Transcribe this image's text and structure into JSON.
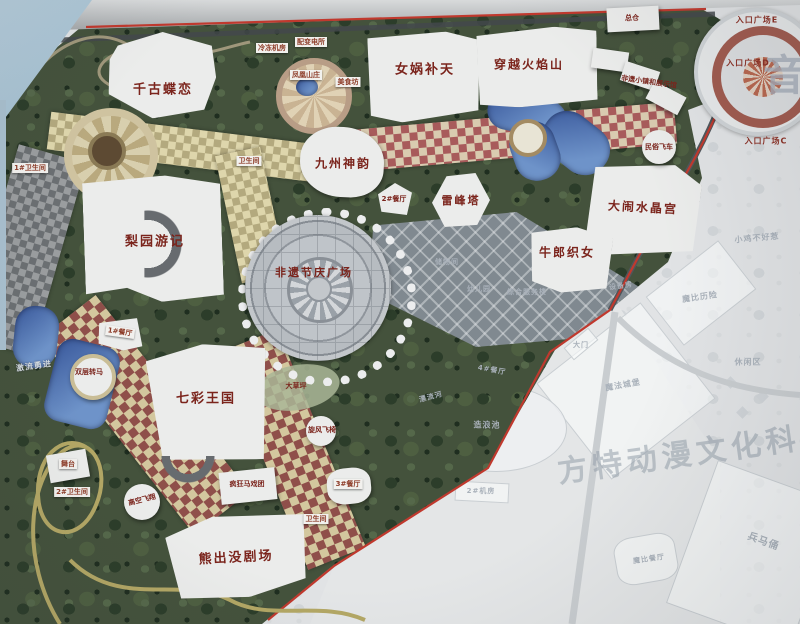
{
  "park": {
    "attractions": [
      "千古蝶恋",
      "女娲补天",
      "穿越火焰山",
      "九州神韵",
      "雷峰塔",
      "大闹水晶宫",
      "牛郎织女",
      "梨园游记",
      "非遗节庆广场",
      "七彩王国",
      "熊出没剧场"
    ],
    "rides": [
      "激流勇进",
      "双层转马",
      "高空飞翔",
      "疯狂马戏团",
      "旋风飞椅",
      "民俗飞车"
    ],
    "venues": [
      "舞台",
      "大草坪"
    ],
    "facilities": [
      "1#餐厅",
      "2#餐厅",
      "3#餐厅",
      "总仓",
      "配变电所",
      "冷冻机房",
      "凤凰山庄",
      "美食坊",
      "非遗小镇和展示馆",
      "1#卫生间",
      "卫生间",
      "2#卫生间",
      "卫生间"
    ],
    "entrances": [
      "入口广场E",
      "入口广场D",
      "入口广场C"
    ]
  },
  "adjacent": {
    "labels": [
      "储物间",
      "幼儿园",
      "综合服务楼",
      "设备房",
      "小鸡不好惹",
      "魔比历险",
      "休闲区",
      "魔法城堡",
      "4#餐厅",
      "漂流河",
      "造浪池",
      "2#机房",
      "兵马俑",
      "魔比餐厅",
      "大门"
    ],
    "watermark_character": "音",
    "watermark_title": "方特动漫文化科技"
  },
  "colors": {
    "attraction_label": "#7b241c",
    "boundary_line": "#c0392e",
    "mosaic_maroon": "#8f4f4a",
    "mosaic_cream": "#d3c79e",
    "water": "#4a6fae",
    "foliage": "#44523c",
    "faded_area": "#e1e3e5",
    "faded_label": "#a9b1ba",
    "sky": "#aac4d6"
  }
}
